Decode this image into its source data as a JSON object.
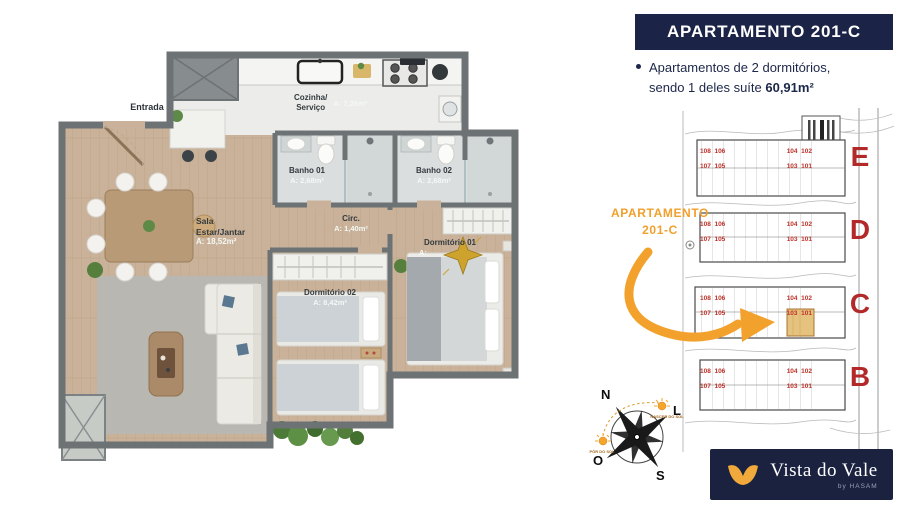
{
  "panel": {
    "title": "APARTAMENTO 201-C",
    "bullet_line1": "Apartamentos de 2 dormitórios,",
    "bullet_line2": "sendo 1 deles suíte ",
    "bullet_area": "60,91m²"
  },
  "floorplan": {
    "entrada": "Entrada",
    "rooms": {
      "cozinha": {
        "name": "Cozinha/",
        "name2": "Serviço",
        "area": "A: 7,28m²"
      },
      "banho1": {
        "name": "Banho 01",
        "area": "A: 2,68m²"
      },
      "banho2": {
        "name": "Banho 02",
        "area": "A: 2,68m²"
      },
      "sala": {
        "name": "Sala",
        "name2": "Estar/Jantar",
        "area": "A: 18,52m²"
      },
      "circ": {
        "name": "Circ.",
        "area": "A: 1,40m²"
      },
      "dorm1": {
        "name": "Dormitório 01",
        "area": "A:"
      },
      "dorm2": {
        "name": "Dormitório 02",
        "area": "A: 8,42m²"
      }
    }
  },
  "map": {
    "callout_line1": "APARTAMENTO",
    "callout_line2": "201-C",
    "buildings": [
      {
        "label": "E",
        "top": "108  106",
        "top2": "104  102",
        "bottom": "107  105",
        "bottom2": "103  101"
      },
      {
        "label": "D",
        "top": "108  106",
        "top2": "104  102",
        "bottom": "107  105",
        "bottom2": "103  101"
      },
      {
        "label": "C",
        "top": "108  106",
        "top2": "104  102",
        "bottom": "107  105",
        "bottom2": "103  101"
      },
      {
        "label": "B",
        "top": "108  106",
        "top2": "104  102",
        "bottom": "107  105",
        "bottom2": "103  101"
      }
    ]
  },
  "compass": {
    "n": "N",
    "l": "L",
    "o": "O",
    "s": "S",
    "sunrise": "NASCER DO SOL",
    "sunset": "PÔR DO SOL"
  },
  "logo": {
    "name": "Vista do Vale",
    "by": "by HASAM"
  },
  "colors": {
    "navy": "#1b2347",
    "orange": "#f2a12e",
    "map_red": "#b3292a",
    "highlight": "#e5c27e",
    "wood": "#c9b299"
  }
}
